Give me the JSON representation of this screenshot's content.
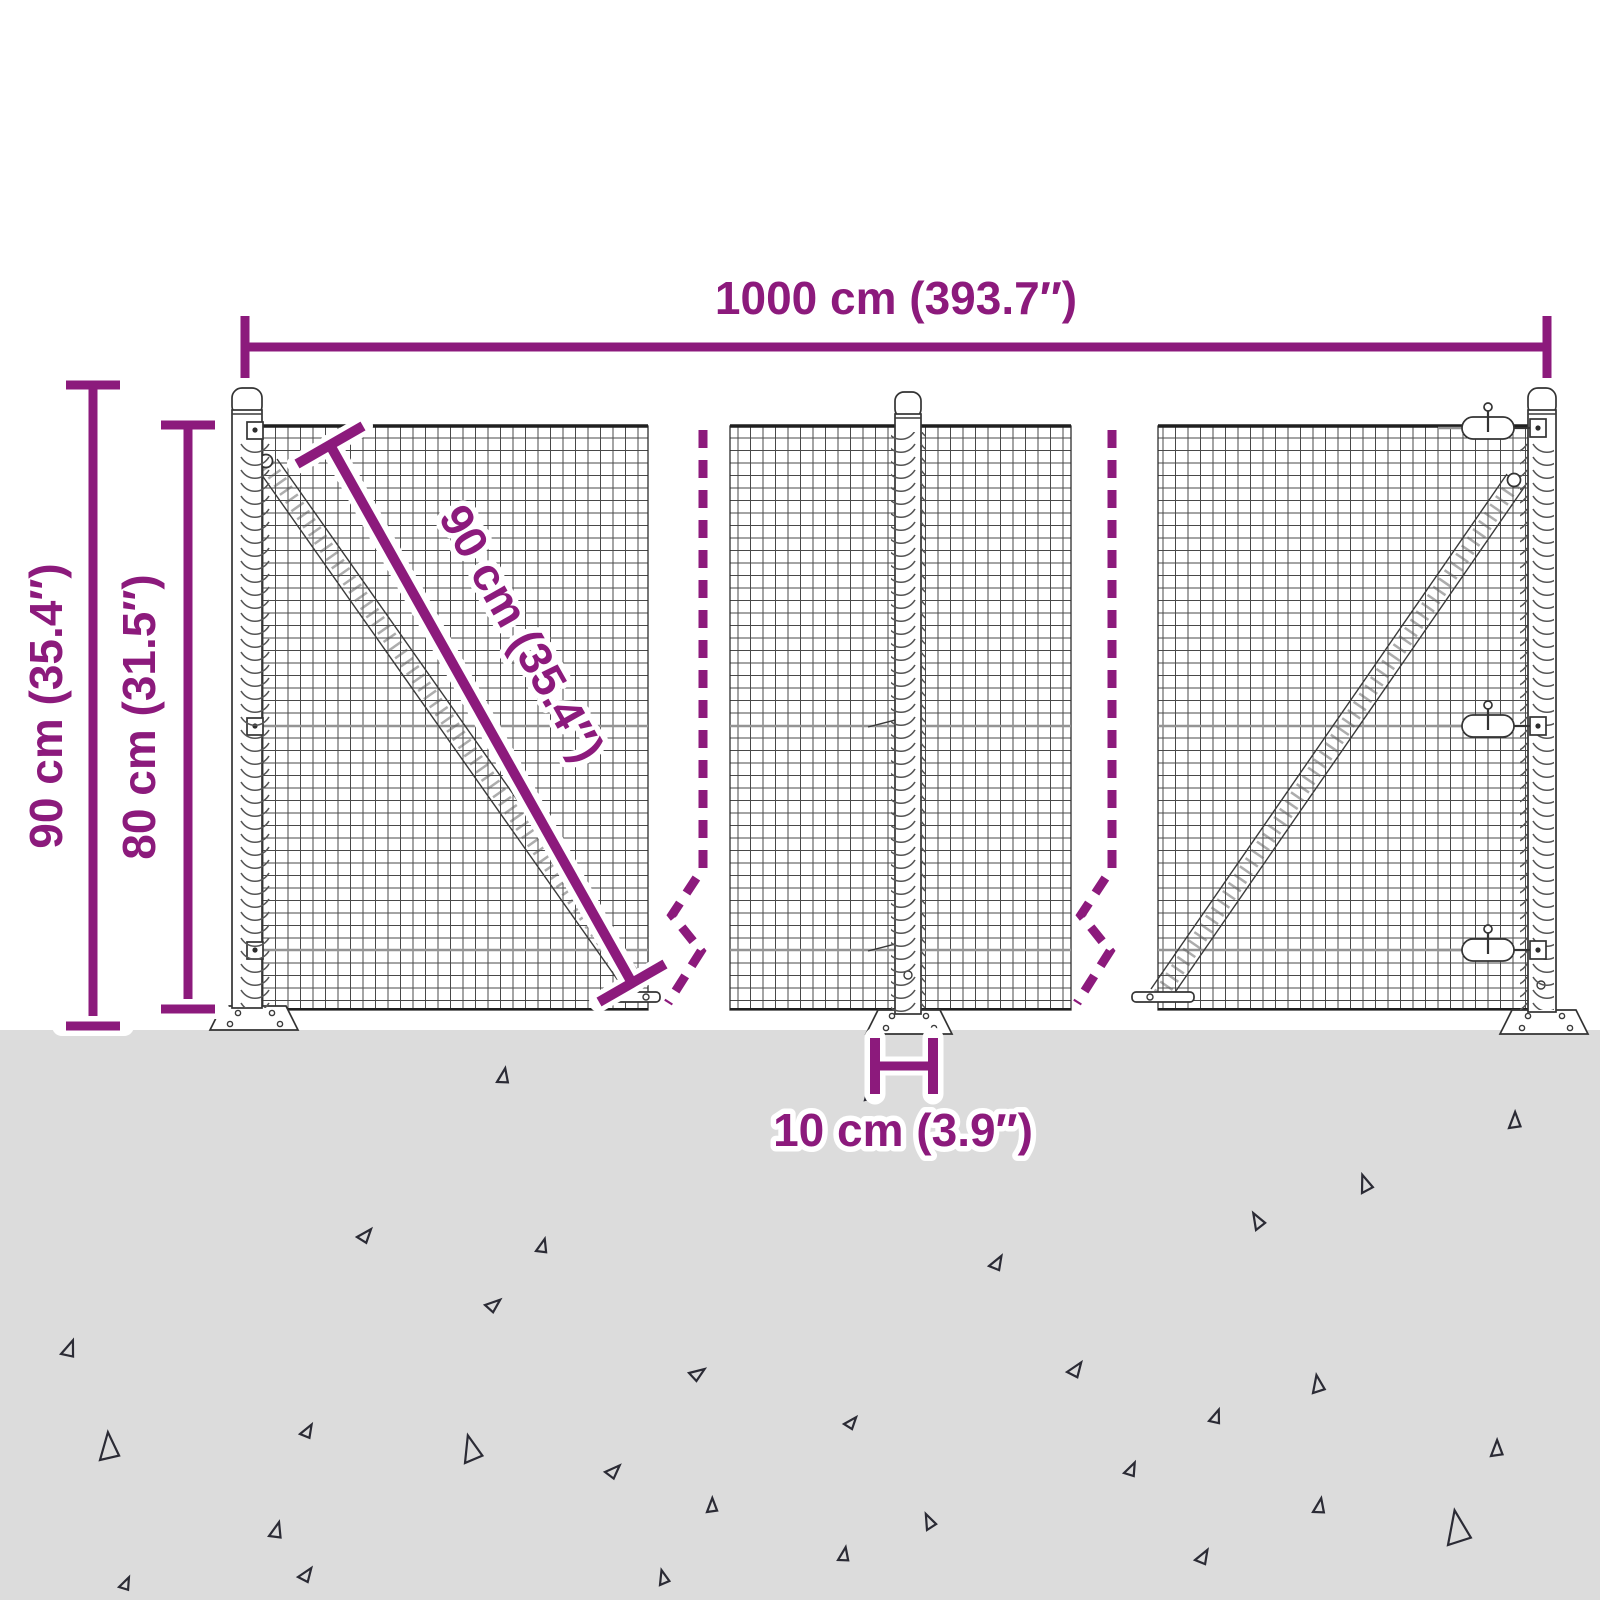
{
  "diagram": {
    "labels": {
      "width": "1000 cm (393.7″)",
      "height_total": "90 cm (35.4″)",
      "height_mesh": "80 cm (31.5″)",
      "diagonal": "90 cm (35.4″)",
      "post_offset": "10 cm (3.9″)"
    }
  },
  "colors": {
    "accent": "#8c1a7c",
    "ground": "#dcdcdc",
    "line-dark": "#2b2b35",
    "background": "#ffffff"
  },
  "ground": {
    "triangles": [
      [
        497,
        1082,
        15,
        10
      ],
      [
        865,
        1100,
        13,
        -5
      ],
      [
        1509,
        1128,
        16,
        0
      ],
      [
        1362,
        1193,
        17,
        -20
      ],
      [
        357,
        1237,
        15,
        40
      ],
      [
        536,
        1251,
        14,
        15
      ],
      [
        1256,
        1230,
        16,
        -30
      ],
      [
        989,
        1266,
        15,
        30
      ],
      [
        61,
        1354,
        17,
        20
      ],
      [
        485,
        1305,
        15,
        50
      ],
      [
        689,
        1373,
        15,
        55
      ],
      [
        1067,
        1372,
        16,
        35
      ],
      [
        1313,
        1393,
        17,
        -10
      ],
      [
        1209,
        1421,
        14,
        20
      ],
      [
        844,
        1424,
        13,
        40
      ],
      [
        300,
        1434,
        14,
        30
      ],
      [
        1491,
        1456,
        16,
        0
      ],
      [
        100,
        1460,
        27,
        -5
      ],
      [
        465,
        1463,
        26,
        -15
      ],
      [
        1124,
        1473,
        14,
        25
      ],
      [
        605,
        1472,
        15,
        45
      ],
      [
        269,
        1536,
        16,
        15
      ],
      [
        927,
        1530,
        15,
        -25
      ],
      [
        1313,
        1512,
        15,
        10
      ],
      [
        707,
        1512,
        14,
        0
      ],
      [
        1195,
        1560,
        15,
        30
      ],
      [
        119,
        1587,
        13,
        25
      ],
      [
        298,
        1577,
        15,
        35
      ],
      [
        660,
        1585,
        14,
        -15
      ],
      [
        1448,
        1545,
        33,
        -10
      ],
      [
        838,
        1560,
        14,
        10
      ]
    ]
  }
}
